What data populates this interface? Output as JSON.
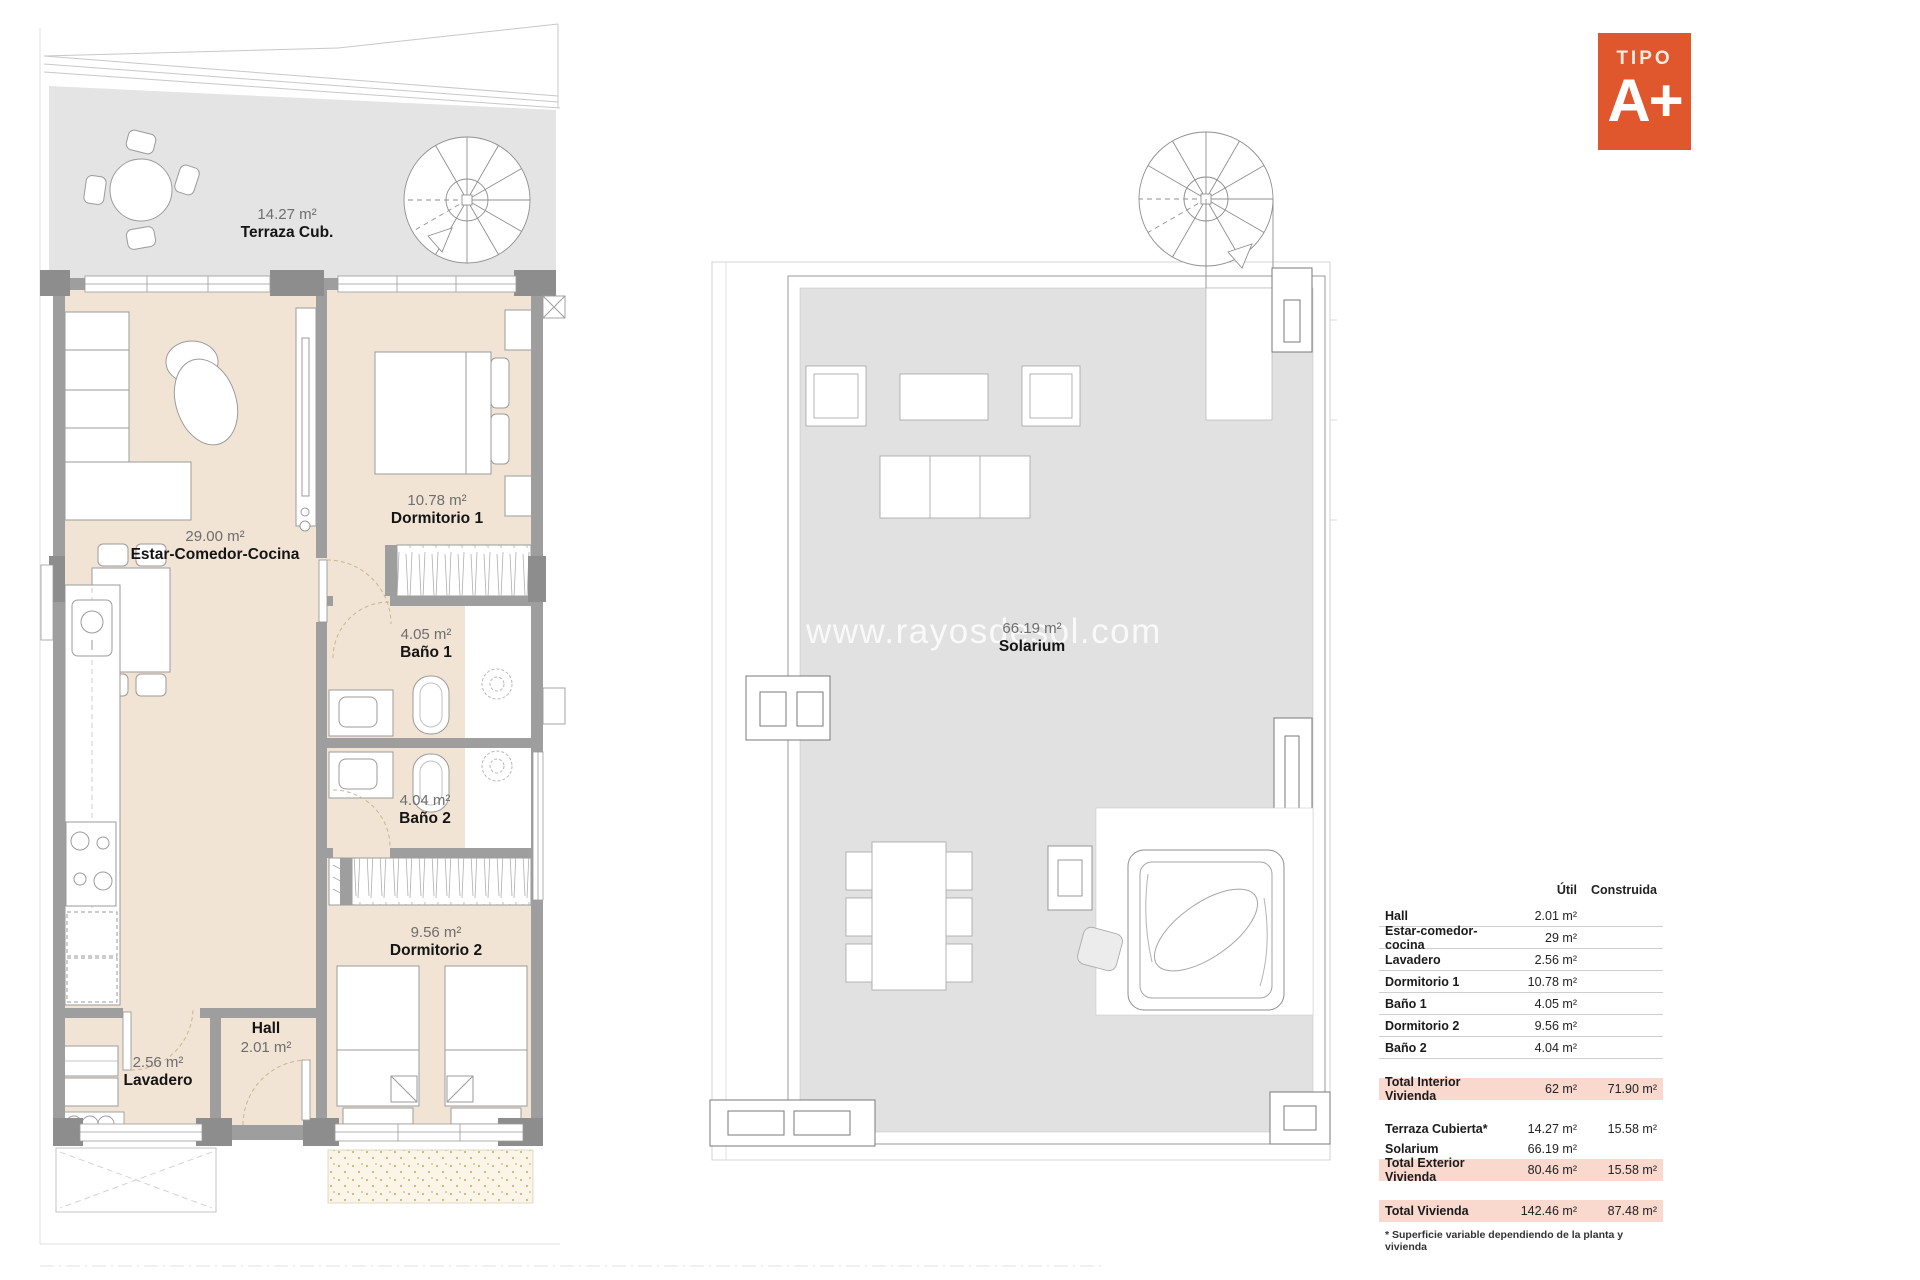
{
  "badge": {
    "eyebrow": "TIPO",
    "label": "A+",
    "color": "#E0572E"
  },
  "watermark": {
    "text": "www.rayosdesol.com"
  },
  "plans": {
    "apartment": {
      "terraza": {
        "area": "14.27 m²",
        "name": "Terraza Cub."
      },
      "estar": {
        "area": "29.00 m²",
        "name": "Estar-Comedor-Cocina"
      },
      "dormitorio1": {
        "area": "10.78 m²",
        "name": "Dormitorio 1"
      },
      "bano1": {
        "area": "4.05 m²",
        "name": "Baño 1"
      },
      "bano2": {
        "area": "4.04 m²",
        "name": "Baño 2"
      },
      "dormitorio2": {
        "area": "9.56 m²",
        "name": "Dormitorio 2"
      },
      "hall": {
        "name": "Hall",
        "area": "2.01 m²"
      },
      "lavadero": {
        "area": "2.56 m²",
        "name": "Lavadero"
      }
    },
    "solarium": {
      "area": "66.19 m²",
      "name": "Solarium"
    }
  },
  "area_table": {
    "headers": {
      "util": "Útil",
      "construida": "Construida"
    },
    "rows": [
      {
        "label": "Hall",
        "util": "2.01 m²",
        "construida": ""
      },
      {
        "label": "Estar-comedor-cocina",
        "util": "29 m²",
        "construida": ""
      },
      {
        "label": "Lavadero",
        "util": "2.56 m²",
        "construida": ""
      },
      {
        "label": "Dormitorio 1",
        "util": "10.78 m²",
        "construida": ""
      },
      {
        "label": "Baño 1",
        "util": "4.05 m²",
        "construida": ""
      },
      {
        "label": "Dormitorio 2",
        "util": "9.56 m²",
        "construida": ""
      },
      {
        "label": "Baño 2",
        "util": "4.04 m²",
        "construida": ""
      }
    ],
    "total_interior": {
      "label": "Total Interior Vivienda",
      "util": "62 m²",
      "construida": "71.90 m²"
    },
    "exterior_rows": [
      {
        "label": "Terraza Cubierta*",
        "util": "14.27 m²",
        "construida": "15.58 m²"
      },
      {
        "label": "Solarium",
        "util": "66.19 m²",
        "construida": ""
      }
    ],
    "total_exterior": {
      "label": "Total Exterior Vivienda",
      "util": "80.46 m²",
      "construida": "15.58 m²"
    },
    "total_vivienda": {
      "label": "Total Vivienda",
      "util": "142.46 m²",
      "construida": "87.48 m²"
    },
    "footnote": "* Superficie variable dependiendo de la planta y vivienda",
    "highlight_color": "#F9D8CE"
  },
  "colors": {
    "floor": "#F2E4D4",
    "terrace": "#E4E4E4",
    "solarium": "#E1E1E1",
    "walls": "#9E9E9E"
  }
}
